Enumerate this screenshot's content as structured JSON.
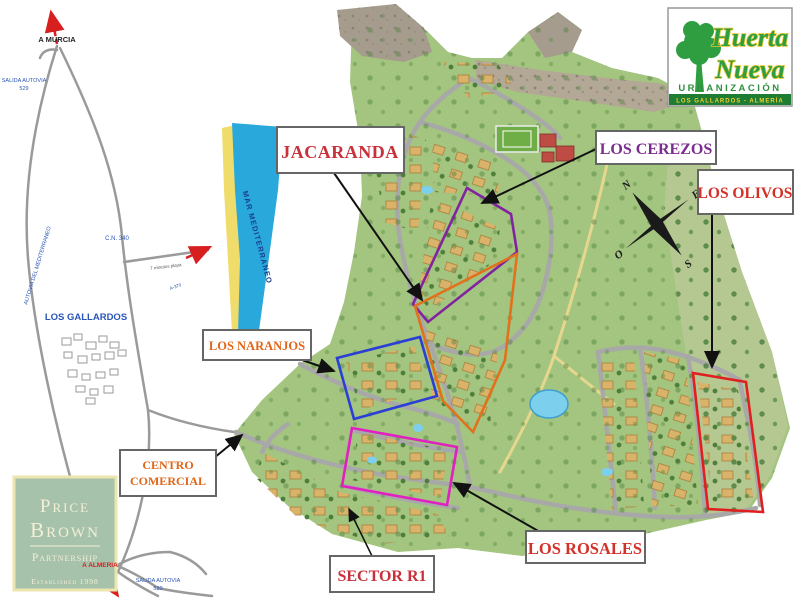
{
  "brand": {
    "name_line1": "Huerta",
    "name_line2": "Nueva",
    "subtitle": "URBANIZACIÓN",
    "location": "LOS GALLARDOS - ALMERÍA"
  },
  "agency": {
    "line1": "Price",
    "line2": "Brown",
    "line3": "Partnership",
    "established": "Established 1998"
  },
  "labels": {
    "jacaranda": "JACARANDA",
    "cerezos": "LOS CEREZOS",
    "olivos": "LOS OLIVOS",
    "naranjos": "LOS NARANJOS",
    "centro_line1": "CENTRO",
    "centro_line2": "COMERCIAL",
    "sector_r1": "SECTOR R1",
    "rosales": "LOS ROSALES"
  },
  "roadmap": {
    "a_murcia": "A MURCIA",
    "salida_north_line1": "SALIDA AUTOVIA",
    "salida_north_line2": "529",
    "autovia": "AUTOVIA DEL MEDITERRANEO",
    "cn340": "C.N. 340",
    "town": "LOS GALLARDOS",
    "beach_road": "7 minutos playa",
    "beach_road_number": "A-370",
    "a_almeria": "A ALMERIA",
    "salida_south_line1": "SALIDA AUTOVIA",
    "salida_south_line2": "520",
    "sea": "MAR MEDITERRANEO"
  },
  "compass": {
    "north": "N",
    "east": "E",
    "south": "S",
    "west": "O"
  },
  "colors": {
    "jacaranda_outline": "#e2711d",
    "cerezos_outline": "#8224a0",
    "olivos_outline": "#e02020",
    "naranjos_outline": "#2b3fd6",
    "rosales_outline": "#e020c0",
    "label_red": "#d43028",
    "label_orange": "#e0661a",
    "label_purple": "#7b2d8e",
    "sea_blue": "#29a8dc",
    "beach_yellow": "#f0dc6a",
    "map_green": "#a3c57f",
    "brand_green": "#2f9e41",
    "brand_yellow": "#e6c832",
    "agency_bg": "#a6c2ab"
  }
}
